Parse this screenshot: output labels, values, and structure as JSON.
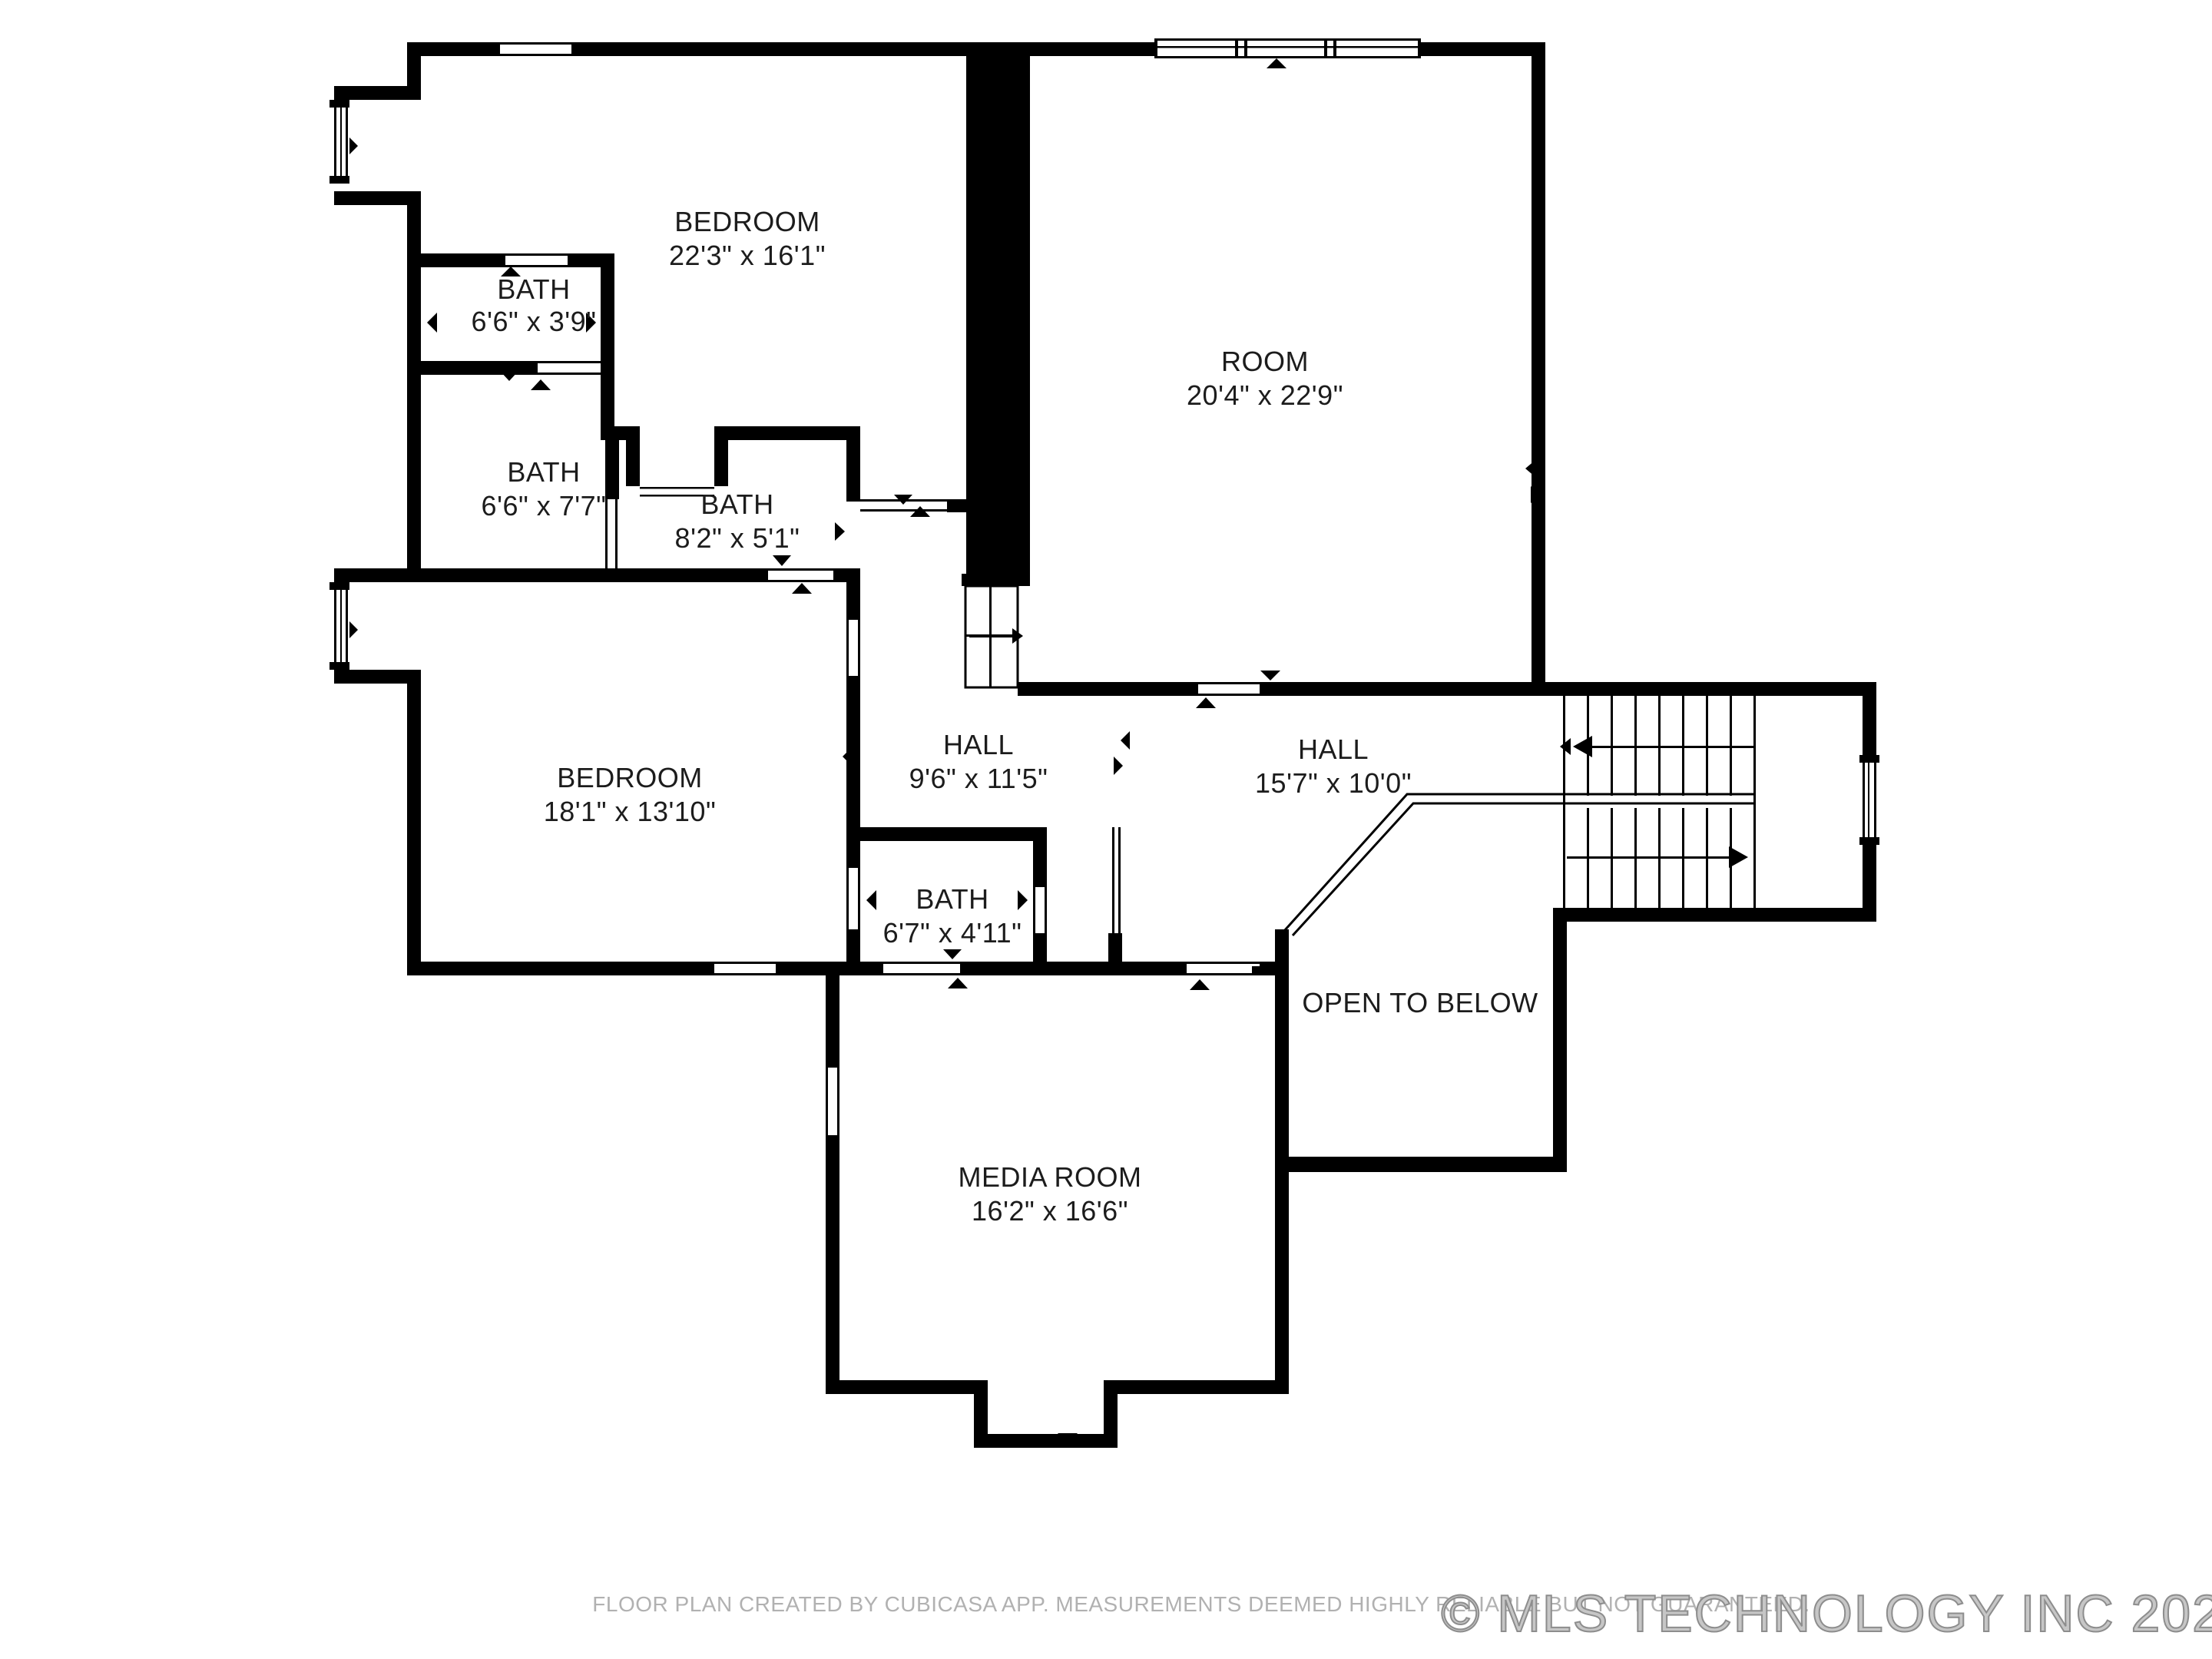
{
  "rooms": {
    "bedroom_top": {
      "label": "BEDROOM",
      "dims": "22'3\" x 16'1\""
    },
    "bath_small": {
      "label": "BATH",
      "dims": "6'6\" x 3'9\""
    },
    "bath_left": {
      "label": "BATH",
      "dims": "6'6\" x 7'7\""
    },
    "bath_mid": {
      "label": "BATH",
      "dims": "8'2\" x 5'1\""
    },
    "room": {
      "label": "ROOM",
      "dims": "20'4\" x 22'9\""
    },
    "bedroom_left": {
      "label": "BEDROOM",
      "dims": "18'1\" x 13'10\""
    },
    "hall_small": {
      "label": "HALL",
      "dims": "9'6\" x 11'5\""
    },
    "hall_large": {
      "label": "HALL",
      "dims": "15'7\" x 10'0\""
    },
    "bath_lower": {
      "label": "BATH",
      "dims": "6'7\" x 4'11\""
    },
    "open_to_below": {
      "label": "OPEN TO BELOW"
    },
    "media_room": {
      "label": "MEDIA ROOM",
      "dims": "16'2\" x 16'6\""
    }
  },
  "footer": {
    "disclaimer": "FLOOR PLAN CREATED BY CUBICASA APP. MEASUREMENTS DEEMED HIGHLY RELIABLE BUT NOT GUARANTEED."
  },
  "watermark": {
    "text": "© MLS TECHNOLOGY INC 2026"
  },
  "colors": {
    "wall": "#000000",
    "label_text": "#1c1c1c",
    "muted_text": "#b1b1b1",
    "watermark": "#c6c6c6",
    "background": "#ffffff"
  }
}
